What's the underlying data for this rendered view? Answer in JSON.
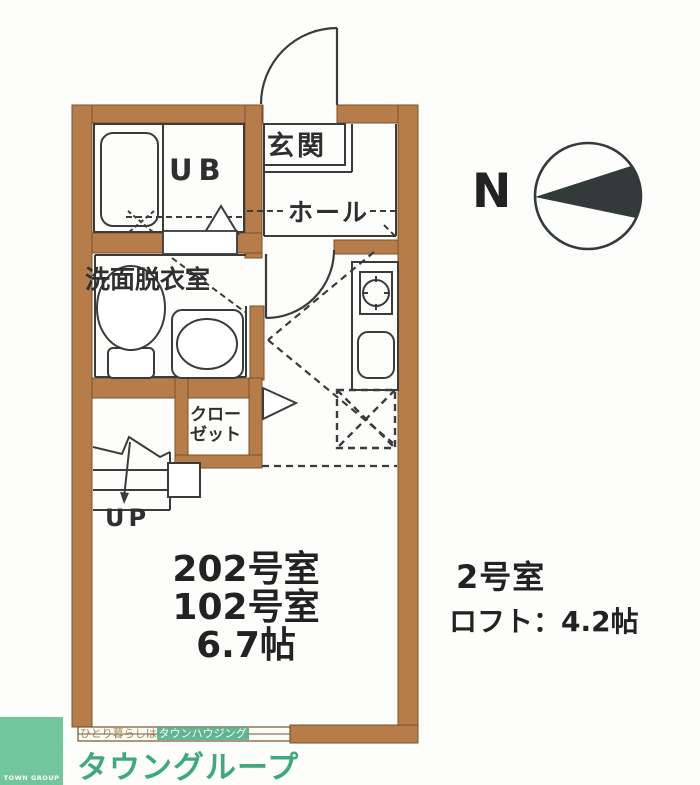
{
  "floor_plan": {
    "labels": {
      "entrance": "玄関",
      "unit_bath": "UB",
      "hall": "ホール",
      "washroom": "洗面脱衣室",
      "closet_line1": "クロー",
      "closet_line2": "ゼット",
      "stairs_up": "UP",
      "room_name_202": "202号室",
      "room_name_102": "102号室",
      "room_size": "6.7帖"
    },
    "colors": {
      "wall_fill": "#b67d4b",
      "wall_outline": "#7a5128",
      "line": "#3b3b3b",
      "compass_fill": "#333b3a"
    }
  },
  "annotations": {
    "compass_north": "N",
    "room_number": "2号室",
    "loft_size": "ロフト：4.2帖"
  },
  "footer": {
    "logo_text": "TOWN GROUP",
    "brand_name": "タウングループ",
    "tagline_plain": "ひとり暮らしは",
    "tagline_highlight": "タウンハウジング",
    "brand_color": "#3fa97d"
  }
}
